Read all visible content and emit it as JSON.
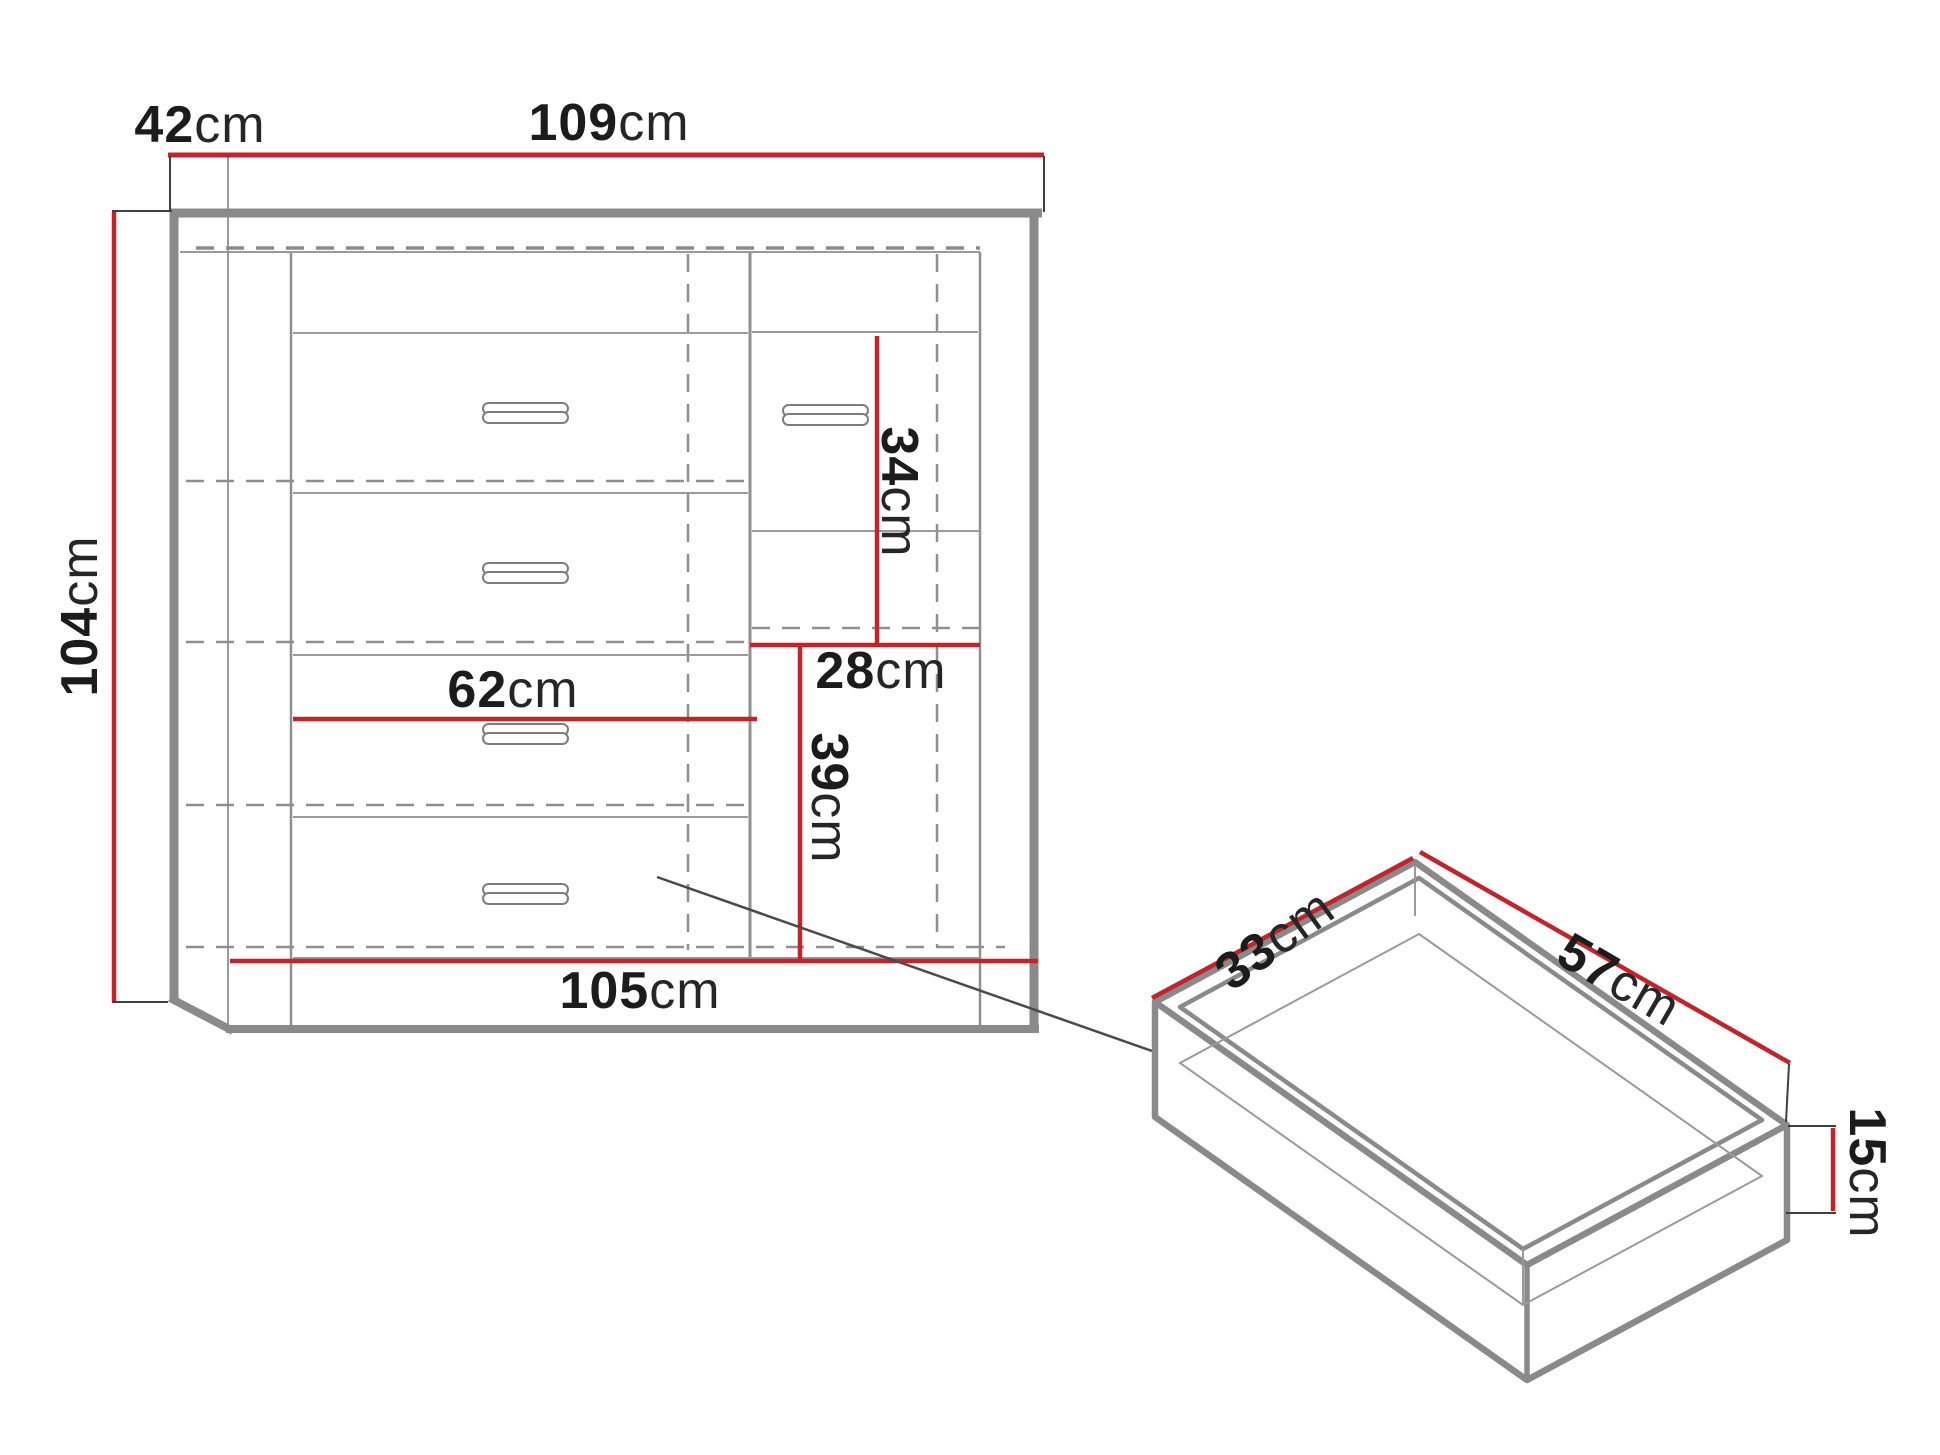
{
  "figure": {
    "type": "furniture-dimension-diagram",
    "views": [
      "cabinet-front-view",
      "drawer-isometric-view"
    ]
  },
  "colors": {
    "dimension_red": "#c2242a",
    "line_gray": "#8a8a8a",
    "text_black": "#1c1c1c"
  },
  "labels": {
    "depth_top": {
      "value": "42",
      "unit": "cm"
    },
    "width_top": {
      "value": "109",
      "unit": "cm"
    },
    "height_left": {
      "value": "104",
      "unit": "cm"
    },
    "drawer_inner_width": {
      "value": "62",
      "unit": "cm"
    },
    "upper_shelf_height": {
      "value": "34",
      "unit": "cm"
    },
    "shelf_width": {
      "value": "28",
      "unit": "cm"
    },
    "lower_shelf_height": {
      "value": "39",
      "unit": "cm"
    },
    "width_bottom": {
      "value": "105",
      "unit": "cm"
    },
    "drawer_depth": {
      "value": "33",
      "unit": "cm"
    },
    "drawer_width": {
      "value": "57",
      "unit": "cm"
    },
    "drawer_height": {
      "value": "15",
      "unit": "cm"
    }
  }
}
